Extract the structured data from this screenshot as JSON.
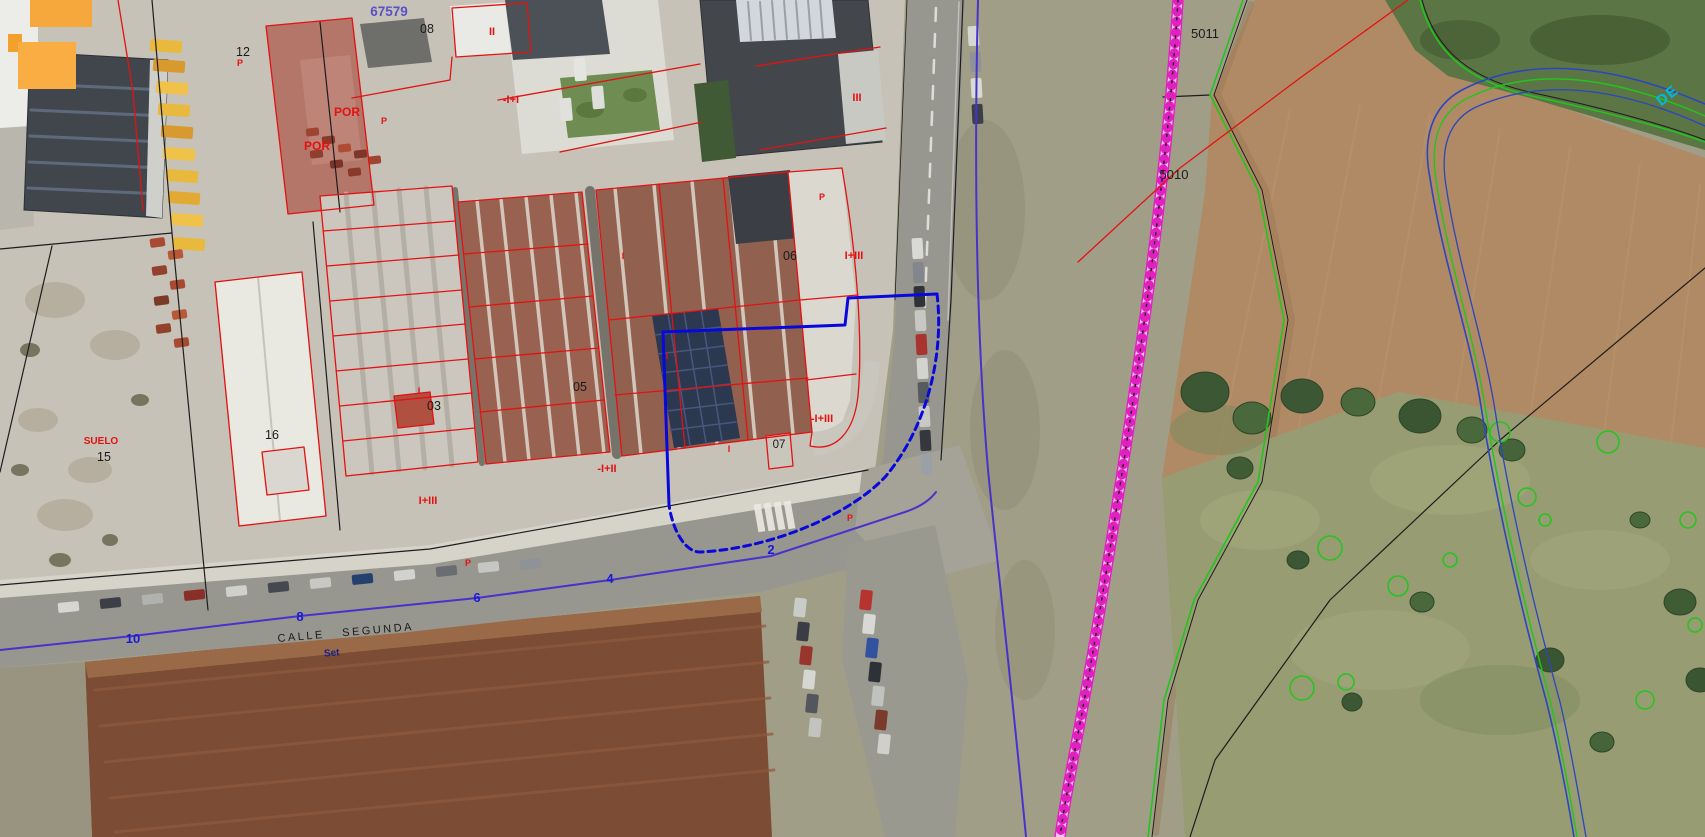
{
  "map": {
    "block_number": "67579",
    "street_name": "CALLE SEGUNDA",
    "canal_label": "DE",
    "road_annotation": "Set",
    "parcel_numbers": {
      "n08": "08",
      "n12": "12",
      "n03": "03",
      "n05": "05",
      "n06": "06",
      "n07": "07",
      "n15": "15",
      "n16": "16",
      "n5010": "5010",
      "n5011": "5011"
    },
    "construction_labels": {
      "ii_left": "II",
      "ii_box": "II",
      "por_upper": "POR",
      "por_lower": "POR",
      "minus_i_plus_i": "-I+I",
      "iii": "III",
      "i_plus_iii_upper": "I+III",
      "minus_i_plus_iii": "-I+III",
      "minus_i_plus_ii": "-I+II",
      "i_plus_iii_lower": "I+III",
      "suelo": "SUELO",
      "p1": "P",
      "p2": "P",
      "p3": "P",
      "p4": "P",
      "p5": "P",
      "i1": "I",
      "i2": "I",
      "i3": "I",
      "i4": "I"
    },
    "chainage_numbers": {
      "c2": "2",
      "c4": "4",
      "c6": "6",
      "c8": "8",
      "c10": "10"
    }
  },
  "colors": {
    "cadastral_red": "#e31212",
    "boundary_black": "#1d1d1d",
    "parcel_blue": "#0808dc",
    "urban_violet": "#4733cc",
    "chainage_blue": "#1a1ad8",
    "railway_magenta": "#e020c0",
    "vegetation_green": "#22c51e",
    "canal_blue": "#2a46c0",
    "canal_label_cyan": "#00b8e0",
    "block_number_purple": "#5a50c8",
    "label_black": "#1a1a1a",
    "road_annotation_blue": "#18208c"
  }
}
